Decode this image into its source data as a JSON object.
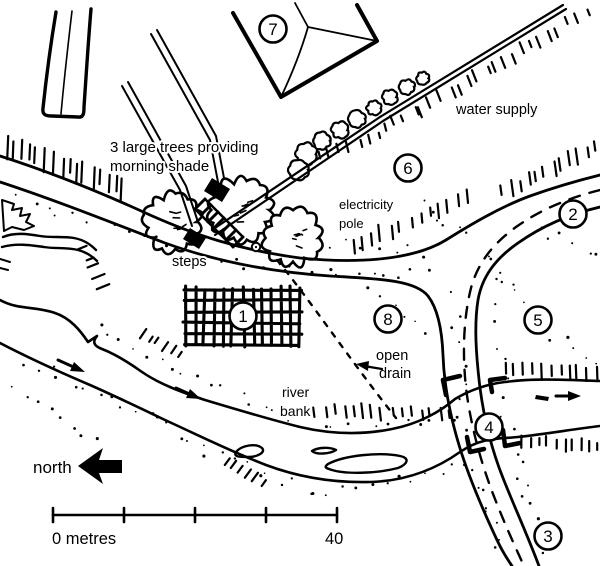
{
  "colors": {
    "ink": "#000000",
    "paper": "#ffffff"
  },
  "annotations": {
    "trees": {
      "line1": "3 large trees providing",
      "line2": "morning shade"
    },
    "water_supply": "water supply",
    "electricity": {
      "line1": "electricity",
      "line2": "pole"
    },
    "steps": "steps",
    "river_bank": {
      "line1": "river",
      "line2": "bank"
    },
    "open_drain": {
      "line1": "open",
      "line2": "drain"
    },
    "north": "north"
  },
  "markers": [
    {
      "number": "1"
    },
    {
      "number": "2"
    },
    {
      "number": "3"
    },
    {
      "number": "4"
    },
    {
      "number": "5"
    },
    {
      "number": "6"
    },
    {
      "number": "7"
    },
    {
      "number": "8"
    }
  ],
  "scale_bar": {
    "zero_label": "0 metres",
    "end_label": "40"
  }
}
